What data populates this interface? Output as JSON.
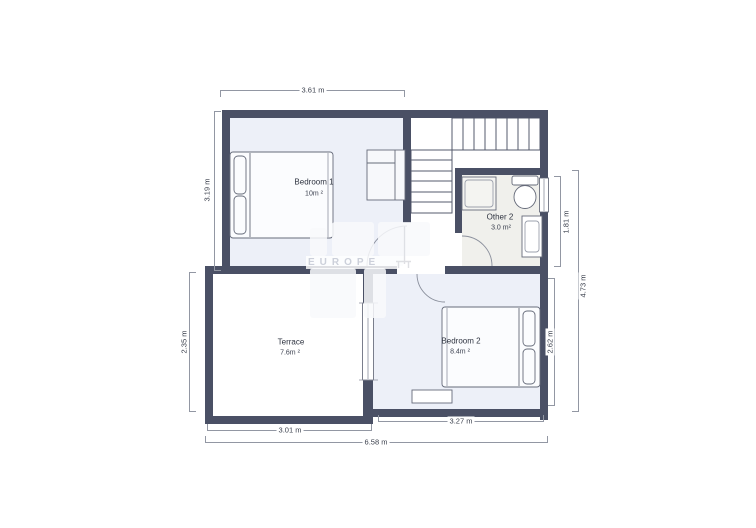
{
  "plan": {
    "title": "floor-plan",
    "rooms": [
      {
        "name": "Bedroom 1",
        "area": "10m ²"
      },
      {
        "name": "Other 2",
        "area": "3.0 m²"
      },
      {
        "name": "Terrace",
        "area": "7.6m ²"
      },
      {
        "name": "Bedroom 2",
        "area": "8.4m ²"
      }
    ],
    "dimensions": [
      {
        "id": "top-bedroom1",
        "label": "3.61 m"
      },
      {
        "id": "left-bedroom1",
        "label": "3.19 m"
      },
      {
        "id": "left-terrace",
        "label": "2.35 m"
      },
      {
        "id": "bottom-terrace",
        "label": "3.01 m"
      },
      {
        "id": "bottom-bedroom2",
        "label": "3.27 m"
      },
      {
        "id": "bottom-overall",
        "label": "6.58 m"
      },
      {
        "id": "right-other2",
        "label": "1.81 m"
      },
      {
        "id": "right-bedroom2",
        "label": "2.62 m"
      },
      {
        "id": "right-overall",
        "label": "4.73 m"
      }
    ],
    "watermark": "EUROPE",
    "colors": {
      "wall": "#4a5065",
      "bedroom_fill": "#edf0f8",
      "other_fill": "#f0f0ec",
      "dimension_line": "#9297a3",
      "fixture_stroke": "#666b7a"
    }
  }
}
